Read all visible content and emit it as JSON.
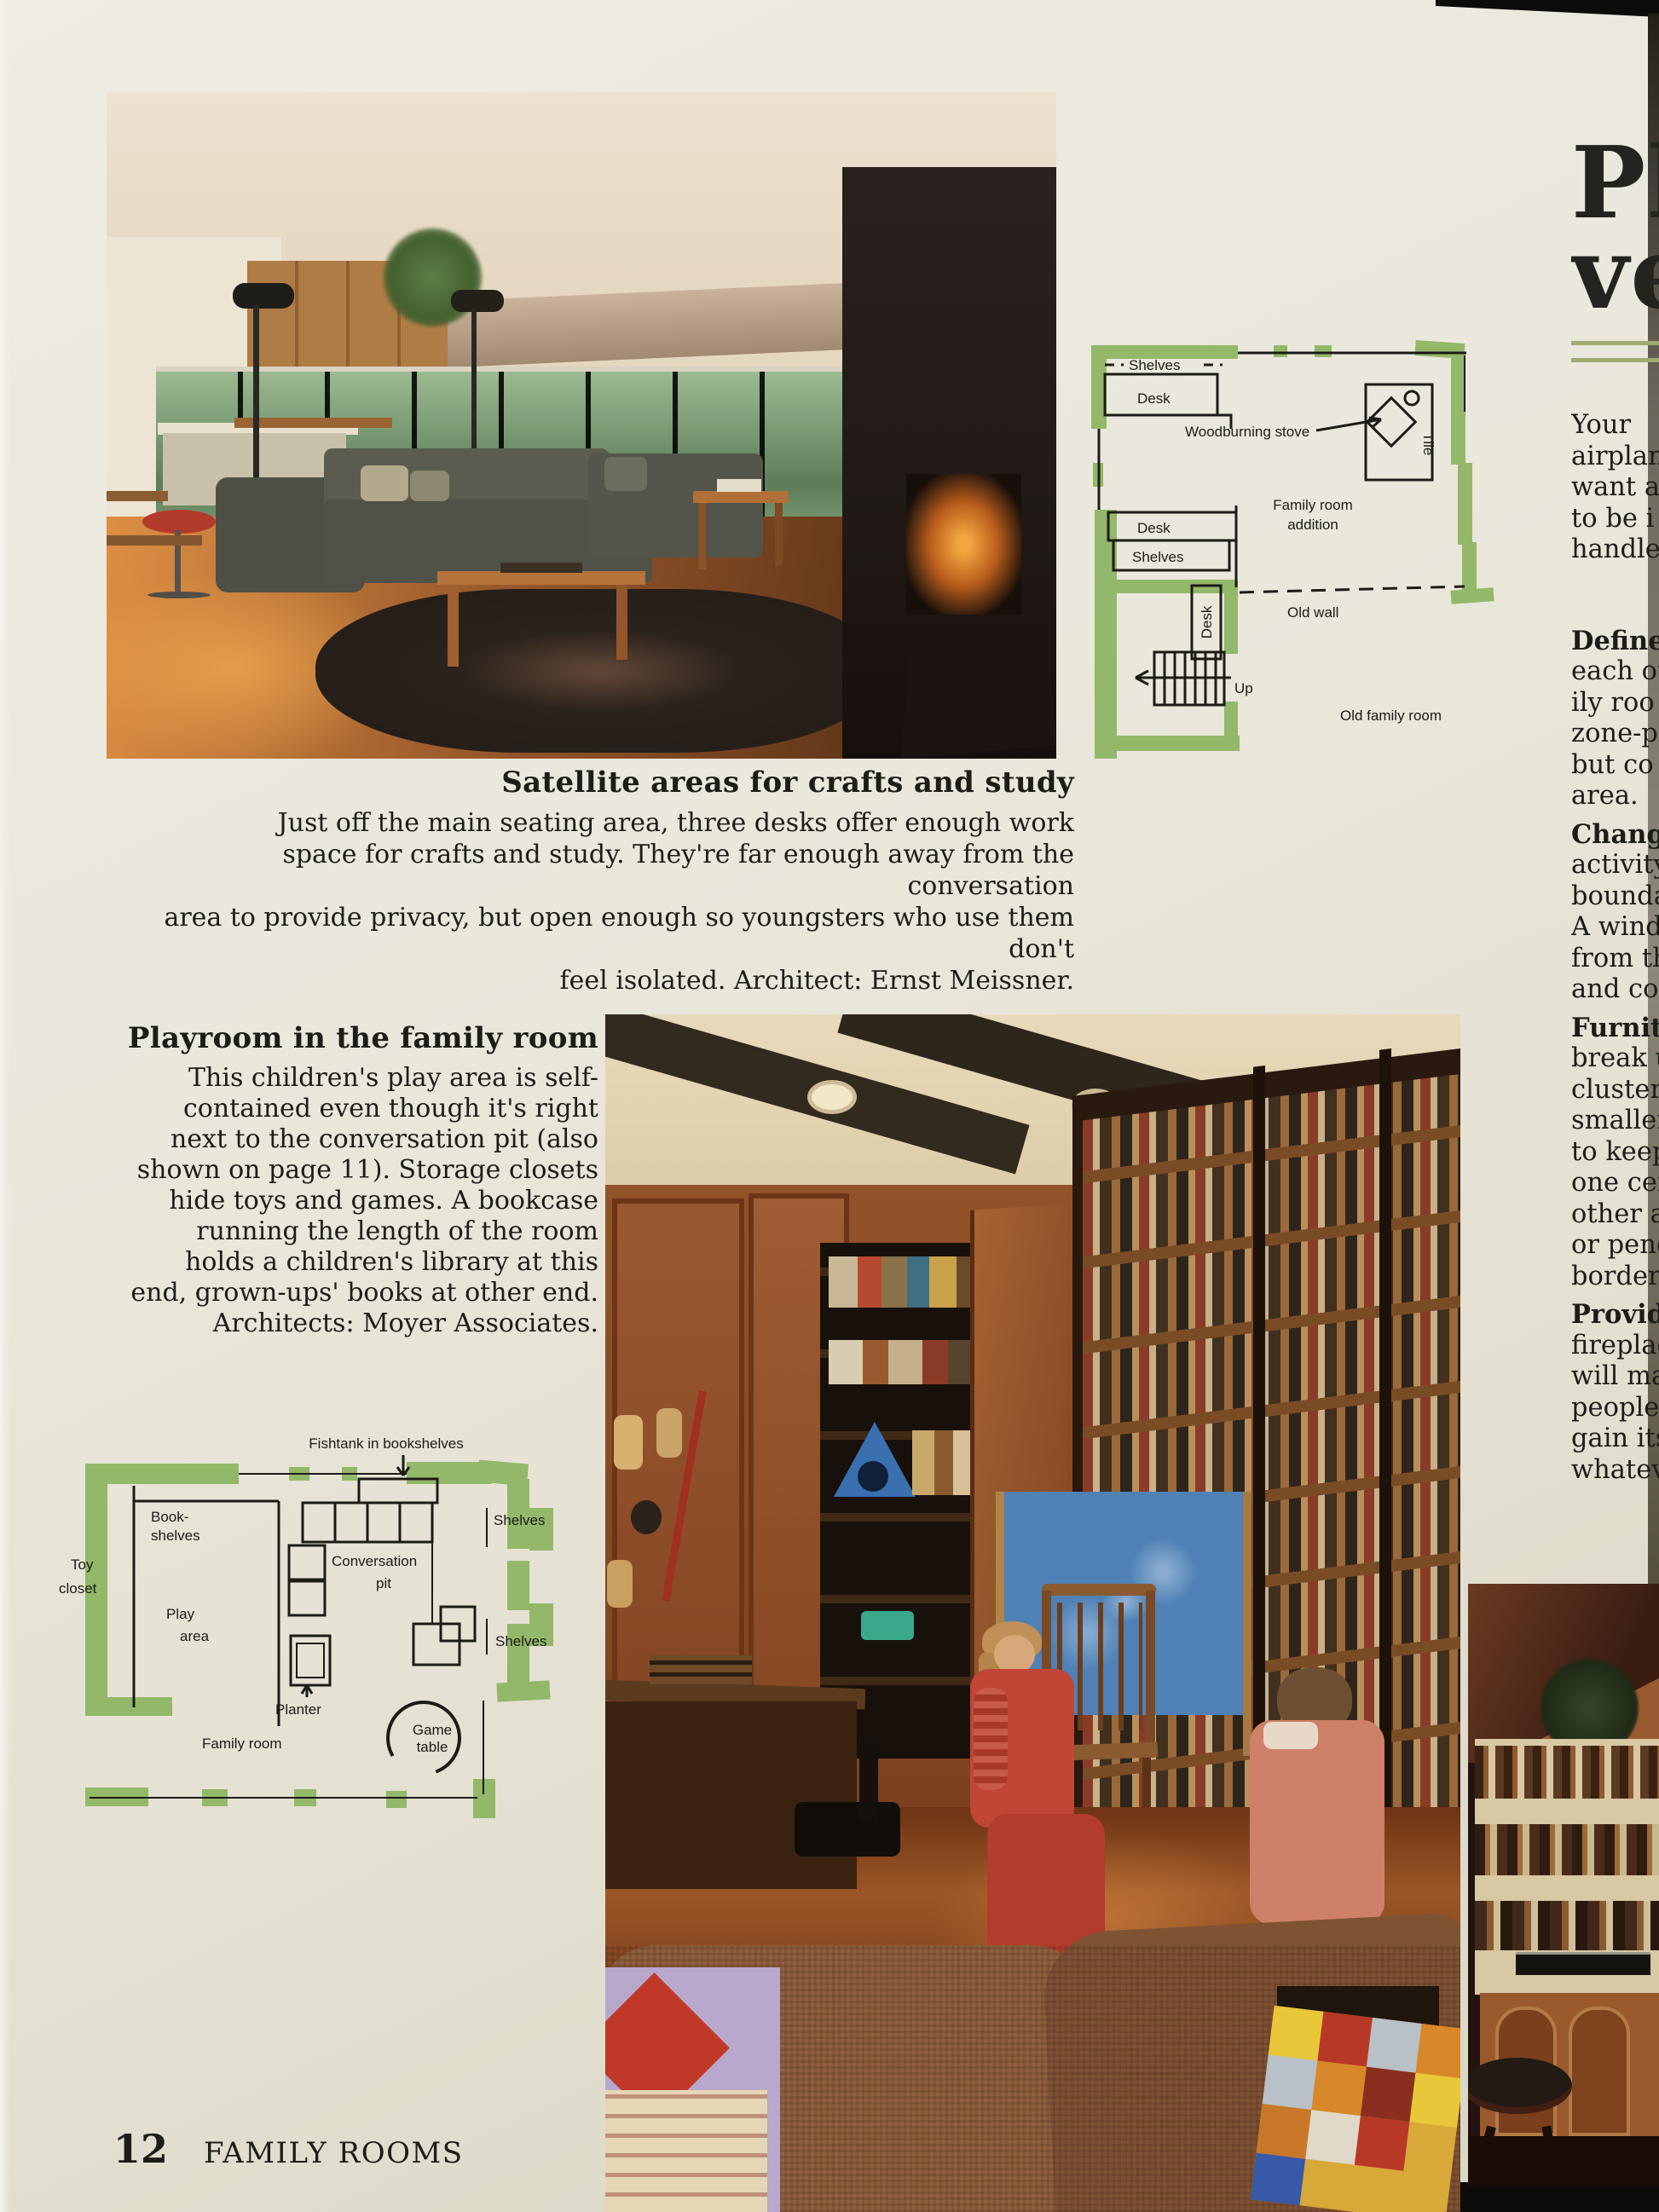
{
  "colors": {
    "plan_green": "#93b869",
    "rule_olive": "#9fac70",
    "page_cream": "#e9e6da",
    "ink": "#1d1c18"
  },
  "footer": {
    "page_number": "12",
    "section_title": "FAMILY ROOMS"
  },
  "caption_satellite": {
    "title": "Satellite areas for crafts and study",
    "lines": [
      "Just off the main seating area, three desks offer enough work",
      "space for crafts and study. They're far enough away from the conversation",
      "area to provide privacy, but open enough so youngsters who use them don't",
      "feel isolated. Architect: Ernst Meissner."
    ]
  },
  "caption_playroom": {
    "title": "Playroom in the family room",
    "lines": [
      "This children's play area is self-",
      "contained even though it's right",
      "next to the conversation pit (also",
      "shown on page 11). Storage closets",
      "hide toys and games. A bookcase",
      "running the length of the room",
      "holds a children's library at this",
      "end, grown-ups' books at other end.",
      "Architects: Moyer Associates."
    ]
  },
  "plan_addition": {
    "shelves_top": "Shelves",
    "desk_top": "Desk",
    "woodburning_stove": "Woodburning stove",
    "tile": "Tile",
    "family_room_1": "Family room",
    "family_room_2": "addition",
    "desk_mid": "Desk",
    "shelves_mid": "Shelves",
    "desk_vertical": "Desk",
    "old_wall": "Old wall",
    "up": "Up",
    "old_family_room": "Old family room"
  },
  "plan_playroom": {
    "fishtank": "Fishtank in bookshelves",
    "bookshelves_1": "Book-",
    "bookshelves_2": "shelves",
    "toy_1": "Toy",
    "toy_2": "closet",
    "play_1": "Play",
    "play_2": "area",
    "pit_1": "Conversation",
    "pit_2": "pit",
    "shelves_top": "Shelves",
    "shelves_bottom": "Shelves",
    "planter": "Planter",
    "family_room": "Family room",
    "game_1": "Game",
    "game_2": "table"
  },
  "right_column": {
    "heading_line1": "Pl",
    "heading_line2": "ve",
    "lines": [
      "Your",
      "airplan",
      "want a",
      "to be i",
      "handle",
      "Define",
      "each ot",
      "ily roo",
      "zone-pl",
      "but co",
      "area.",
      "Changi",
      "activity",
      "bounda",
      "A wind",
      "from th",
      "and co",
      "Furnitu",
      "break u",
      "cluster",
      "smaller",
      "to keep",
      "one cer",
      "other a",
      "or pend",
      "borders",
      "Provide",
      "fireplac",
      "will ma",
      "people s",
      "gain its",
      "whateve"
    ]
  }
}
